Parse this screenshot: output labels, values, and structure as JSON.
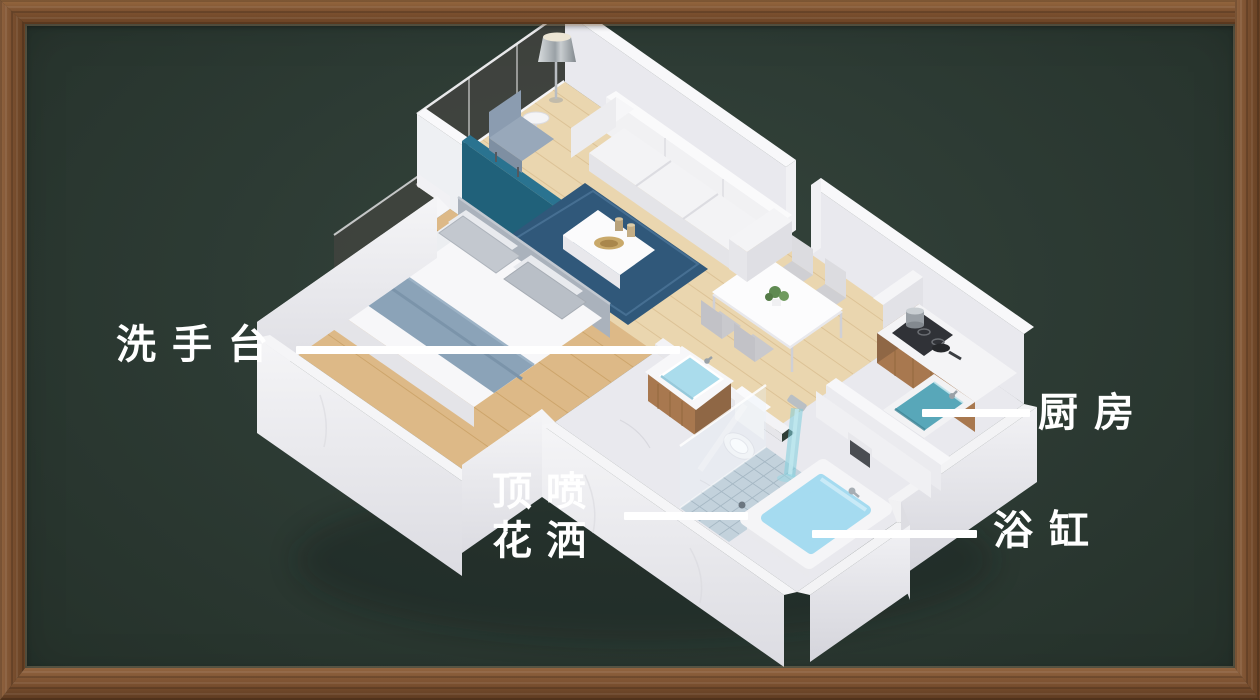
{
  "board": {
    "background": "#2d3b34",
    "frame_color": "#7d5231",
    "description_labels_language": "zh"
  },
  "annotations": {
    "washbasin": {
      "label": "洗手台"
    },
    "kitchen": {
      "label": "厨房"
    },
    "shower": {
      "label_line1": "顶喷",
      "label_line2": "花洒"
    },
    "bathtub": {
      "label": "浴缸"
    }
  },
  "theme": {
    "colors": {
      "label_color": "#ffffff",
      "wood_floor": "#ead6af",
      "wood_floor_dark": "#ddb987",
      "marble": "#e9e9ee",
      "teal_wall": "#20617a",
      "rug_blue": "#30587a",
      "water_blue": "#a5dbf0",
      "sink_teal": "#58a7b9",
      "cabinet_wood": "#a8784f"
    }
  }
}
